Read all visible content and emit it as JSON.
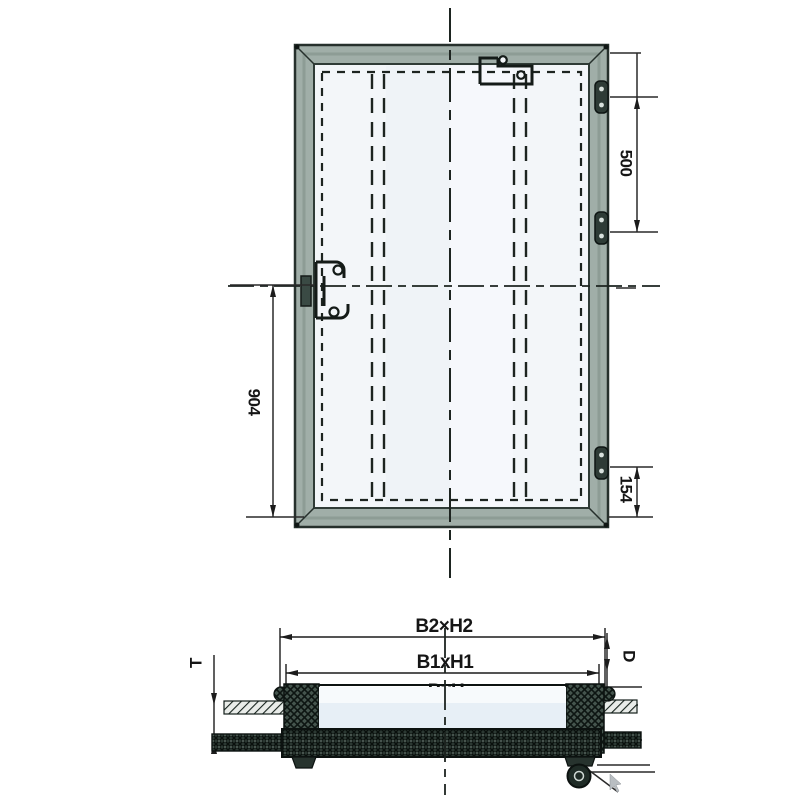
{
  "front_view": {
    "hinge_spacing_dim": "500",
    "handle_to_bottom_dim": "904",
    "hinge_to_bottom_dim": "154"
  },
  "section_view": {
    "outer_dim": "B2×H2",
    "frame_dim": "B1xH1",
    "clear_dim": "BxH",
    "depth_dim": "D",
    "thickness_dim": "T"
  },
  "colors": {
    "frame_fill": "#a0aea8",
    "frame_mid": "#8d9c95",
    "frame_edge": "#26302c",
    "panel_fill": "#f3f6f9",
    "panel_band": "#eef2f6",
    "line": "#1c1c1c",
    "hinge_fill": "#2e3b36",
    "leaf_fill": "#e7eff6",
    "leaf_top": "#f7fafc",
    "hatch_block": "#44544d",
    "cursor_gray": "#b9bec2"
  }
}
